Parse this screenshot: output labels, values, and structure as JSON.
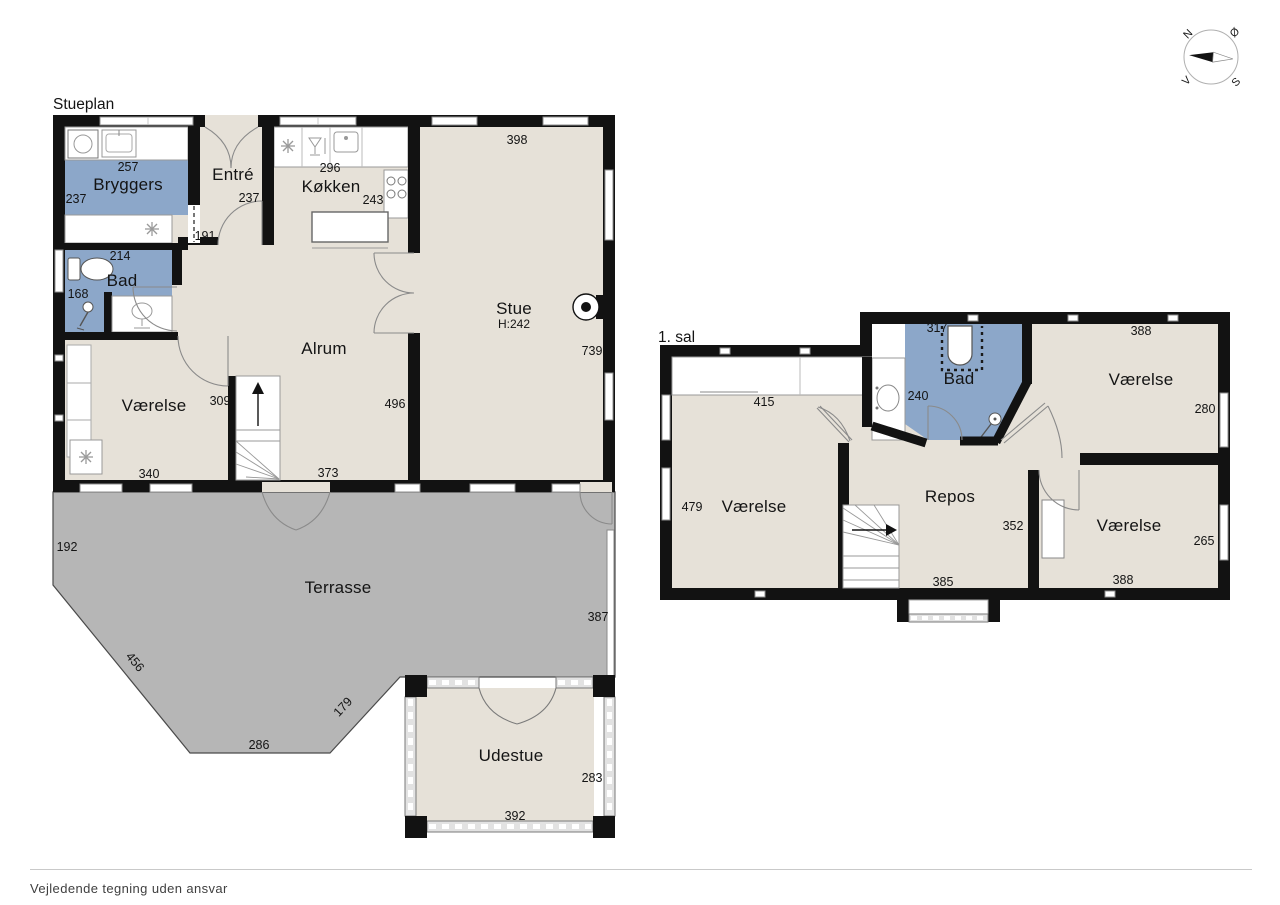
{
  "ground": {
    "title": "Stueplan",
    "bryggers": {
      "label": "Bryggers",
      "width": "257",
      "depth": "237"
    },
    "bad": {
      "label": "Bad",
      "width": "214",
      "depth": "168"
    },
    "varelse": {
      "label": "Værelse",
      "width": "340",
      "depth": "309"
    },
    "entre": {
      "label": "Entré",
      "depth": "237",
      "width": "191"
    },
    "kokken": {
      "label": "Køkken",
      "width": "296",
      "depth": "243"
    },
    "stue": {
      "label": "Stue",
      "ceiling": "H:242",
      "width": "398",
      "depth": "739"
    },
    "alrum": {
      "label": "Alrum",
      "width": "373",
      "wall": "496"
    },
    "terrasse": {
      "label": "Terrasse",
      "left": "192",
      "diag_left": "456",
      "bottom": "286",
      "diag_right": "179",
      "right": "387"
    },
    "udestue": {
      "label": "Udestue",
      "width": "392",
      "depth": "283"
    }
  },
  "first": {
    "title": "1. sal",
    "varelse_left": {
      "label": "Værelse",
      "width": "415",
      "depth": "479"
    },
    "bad": {
      "label": "Bad",
      "width": "317",
      "depth": "240"
    },
    "varelse_ne": {
      "label": "Værelse",
      "width": "388",
      "depth": "280"
    },
    "varelse_se": {
      "label": "Værelse",
      "width": "388",
      "depth": "265"
    },
    "repos": {
      "label": "Repos",
      "width": "385",
      "closet": "352"
    }
  },
  "compass": {
    "north": "N",
    "east": "Ø",
    "south": "S",
    "west": "V"
  },
  "footer": "Vejledende tegning uden ansvar",
  "colors": {
    "wet_room_blue": "#8ca7c9",
    "floor_beige": "#e6e1d8",
    "terrace_gray": "#b6b6b6",
    "wall_black": "#121212",
    "window_band": "#e2e2e2"
  }
}
